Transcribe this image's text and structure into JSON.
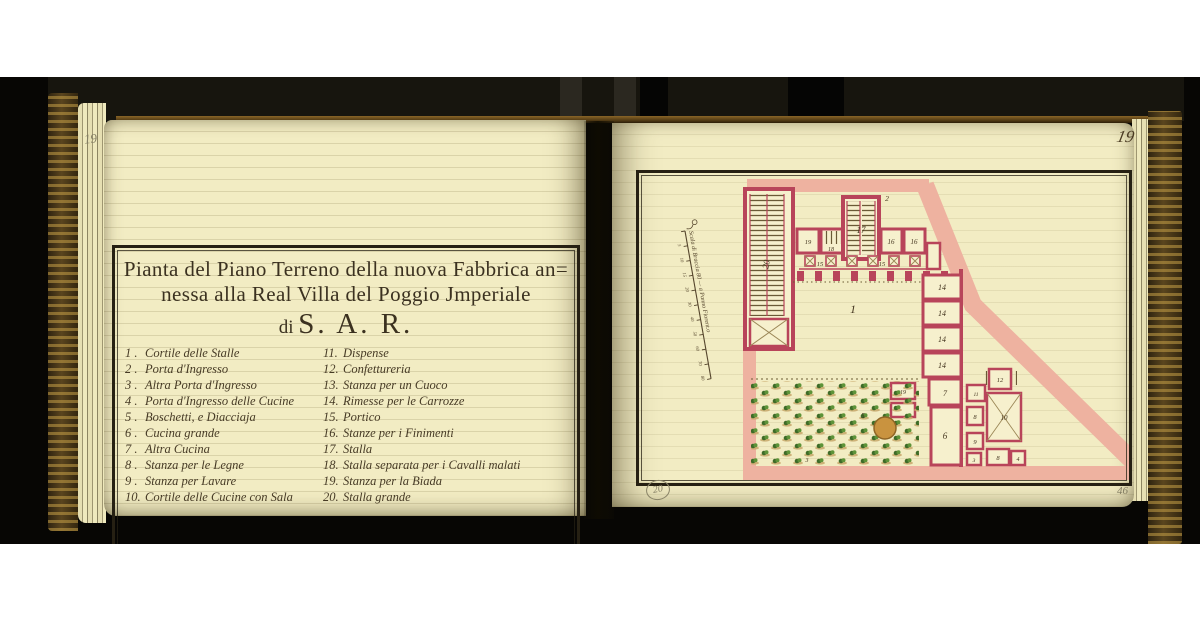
{
  "folios": {
    "left_page_number": "19",
    "right_page_number": "19",
    "bottom_right_number": "46",
    "circled_annotation": "20"
  },
  "title": {
    "line1": "Pianta del Piano Terreno della nuova Fabbrica an=",
    "line2": "nessa alla Real Villa del Poggio Jmperiale",
    "line3_prefix": "di",
    "line3_main": "S. A. R."
  },
  "legend": {
    "left_column": [
      {
        "n": "1 .",
        "t": "Cortile delle Stalle"
      },
      {
        "n": "2 .",
        "t": "Porta d'Ingresso"
      },
      {
        "n": "3 .",
        "t": "Altra Porta d'Ingresso"
      },
      {
        "n": "4 .",
        "t": "Porta d'Ingresso delle Cucine"
      },
      {
        "n": "5 .",
        "t": "Boschetti, e Diacciaja"
      },
      {
        "n": "6 .",
        "t": "Cucina grande"
      },
      {
        "n": "7 .",
        "t": "Altra Cucina"
      },
      {
        "n": "8 .",
        "t": "Stanza per le Legne"
      },
      {
        "n": "9 .",
        "t": "Stanza per Lavare"
      },
      {
        "n": "10.",
        "t": "Cortile delle Cucine con Sala"
      }
    ],
    "right_column": [
      {
        "n": "11.",
        "t": "Dispense"
      },
      {
        "n": "12.",
        "t": "Confettureria"
      },
      {
        "n": "13.",
        "t": "Stanza per un Cuoco"
      },
      {
        "n": "14.",
        "t": "Rimesse per le Carrozze"
      },
      {
        "n": "15.",
        "t": "Portico"
      },
      {
        "n": "16.",
        "t": "Stanze per i Finimenti"
      },
      {
        "n": "17.",
        "t": "Stalla"
      },
      {
        "n": "18.",
        "t": "Stalla separata per i Cavalli malati"
      },
      {
        "n": "19.",
        "t": "Stanza per la Biada"
      },
      {
        "n": "20.",
        "t": "Stalla grande"
      }
    ]
  },
  "plan": {
    "scale_heading": "Scala di Braccia 80 — a Panno Fiorent.o",
    "scale_ticks": [
      "5",
      "10",
      "15",
      "20",
      "30",
      "40",
      "50",
      "60",
      "70",
      "80"
    ],
    "labels": {
      "cortile_stalle": "1",
      "porta_ingresso": "2",
      "altra_porta": "3",
      "altra_porta_b": "3",
      "porta_cucine": "4",
      "boschetti": "5",
      "cucina_grande": "6",
      "altra_cucina": "7",
      "legne_a": "8",
      "legne_b": "8",
      "lavare": "9",
      "cortile_cucine": "10",
      "dispense": "11",
      "confettureria": "12",
      "rimessa_1": "14",
      "rimessa_2": "14",
      "rimessa_3": "14",
      "rimessa_4": "14",
      "portico_a": "15",
      "portico_b": "15",
      "finimenti_a": "16",
      "finimenti_b": "16",
      "stalla": "17",
      "stalla_separata": "18",
      "biada_top": "19",
      "biada": "19",
      "stalla_grande": "20"
    }
  },
  "colors": {
    "wall": "#b8445a",
    "wash": "#eeb2a0",
    "ink": "#44351f",
    "paper": "#f2ecc3",
    "pencil": "#827c62",
    "green": "#4c7a2e",
    "ice": "#c9933f",
    "cover_gold": "#b08c3c"
  }
}
